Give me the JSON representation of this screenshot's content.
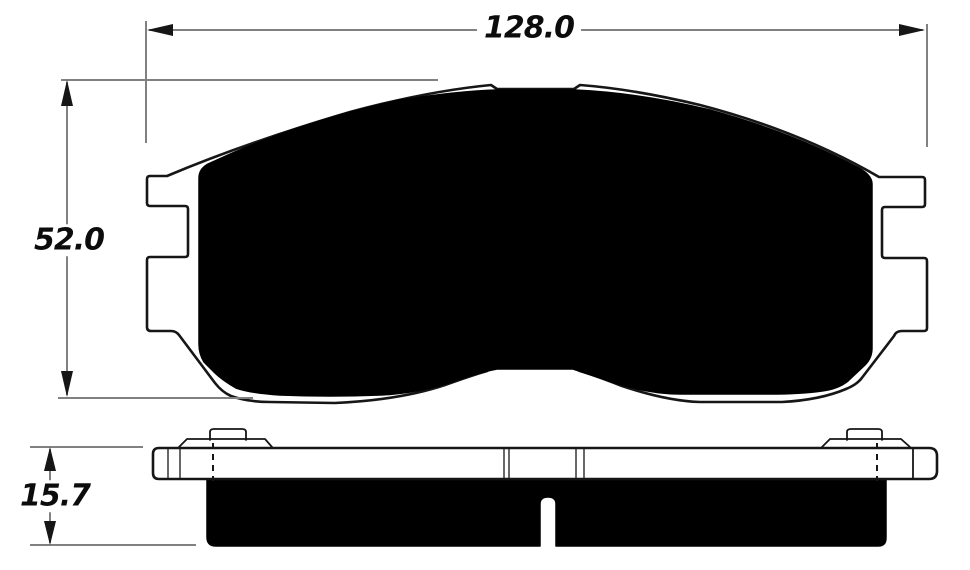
{
  "drawing": {
    "dimensions": {
      "width": {
        "label": "128.0"
      },
      "height": {
        "label": "52.0"
      },
      "thickness": {
        "label": "15.7"
      }
    },
    "colors": {
      "background": "#ffffff",
      "outline": "#161616",
      "friction_fill": "#000000",
      "plate_fill": "#ffffff",
      "dimension_line": "#818181",
      "text": "#0c0c0c"
    }
  }
}
